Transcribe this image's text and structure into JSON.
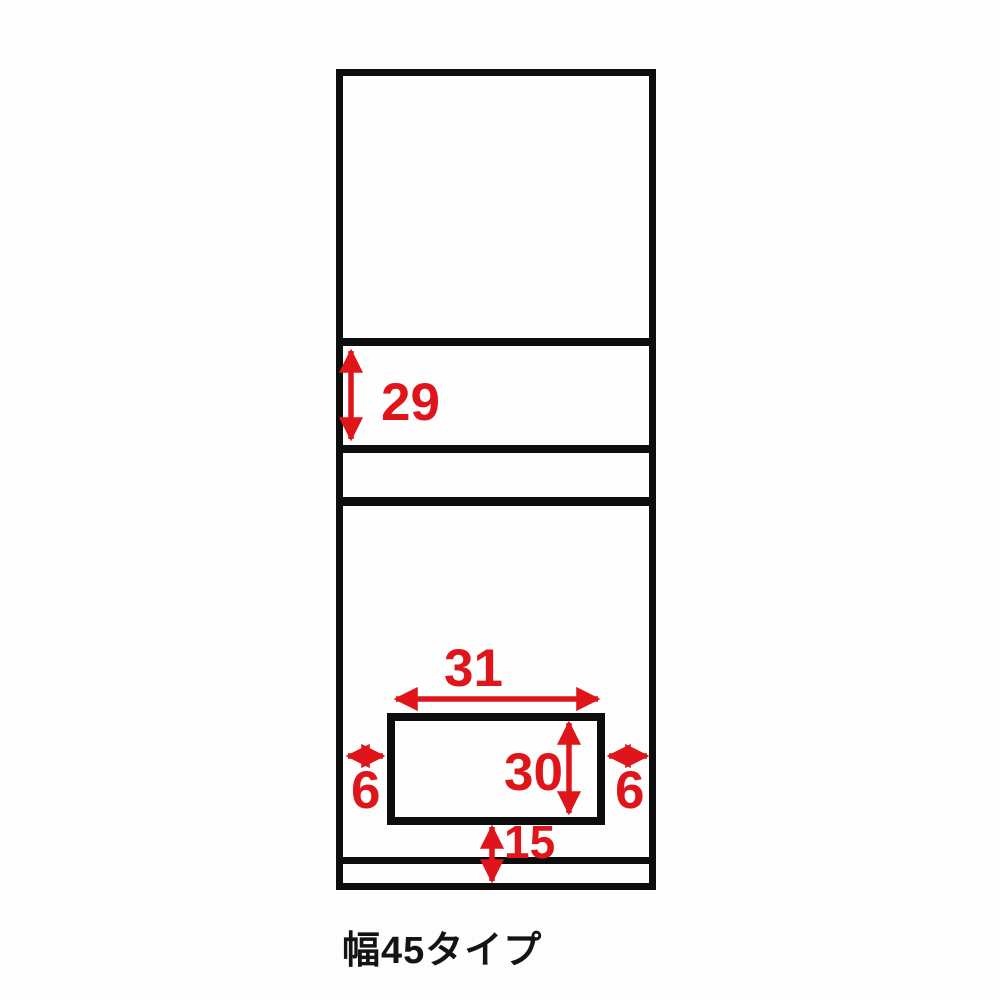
{
  "caption": "幅45タイプ",
  "dimensions": {
    "shelf_section_height": {
      "value": "29",
      "orientation": "vertical",
      "unit_note": "section between first and second divider"
    },
    "opening_width": {
      "value": "31",
      "orientation": "horizontal"
    },
    "opening_height": {
      "value": "30",
      "orientation": "vertical"
    },
    "left_margin": {
      "value": "6",
      "orientation": "horizontal"
    },
    "right_margin": {
      "value": "6",
      "orientation": "horizontal"
    },
    "bottom_clearance": {
      "value": "15",
      "orientation": "vertical"
    }
  },
  "colors": {
    "dimension_red": "#e0151b",
    "line_black": "#0d0d0d",
    "background": "#ffffff"
  }
}
